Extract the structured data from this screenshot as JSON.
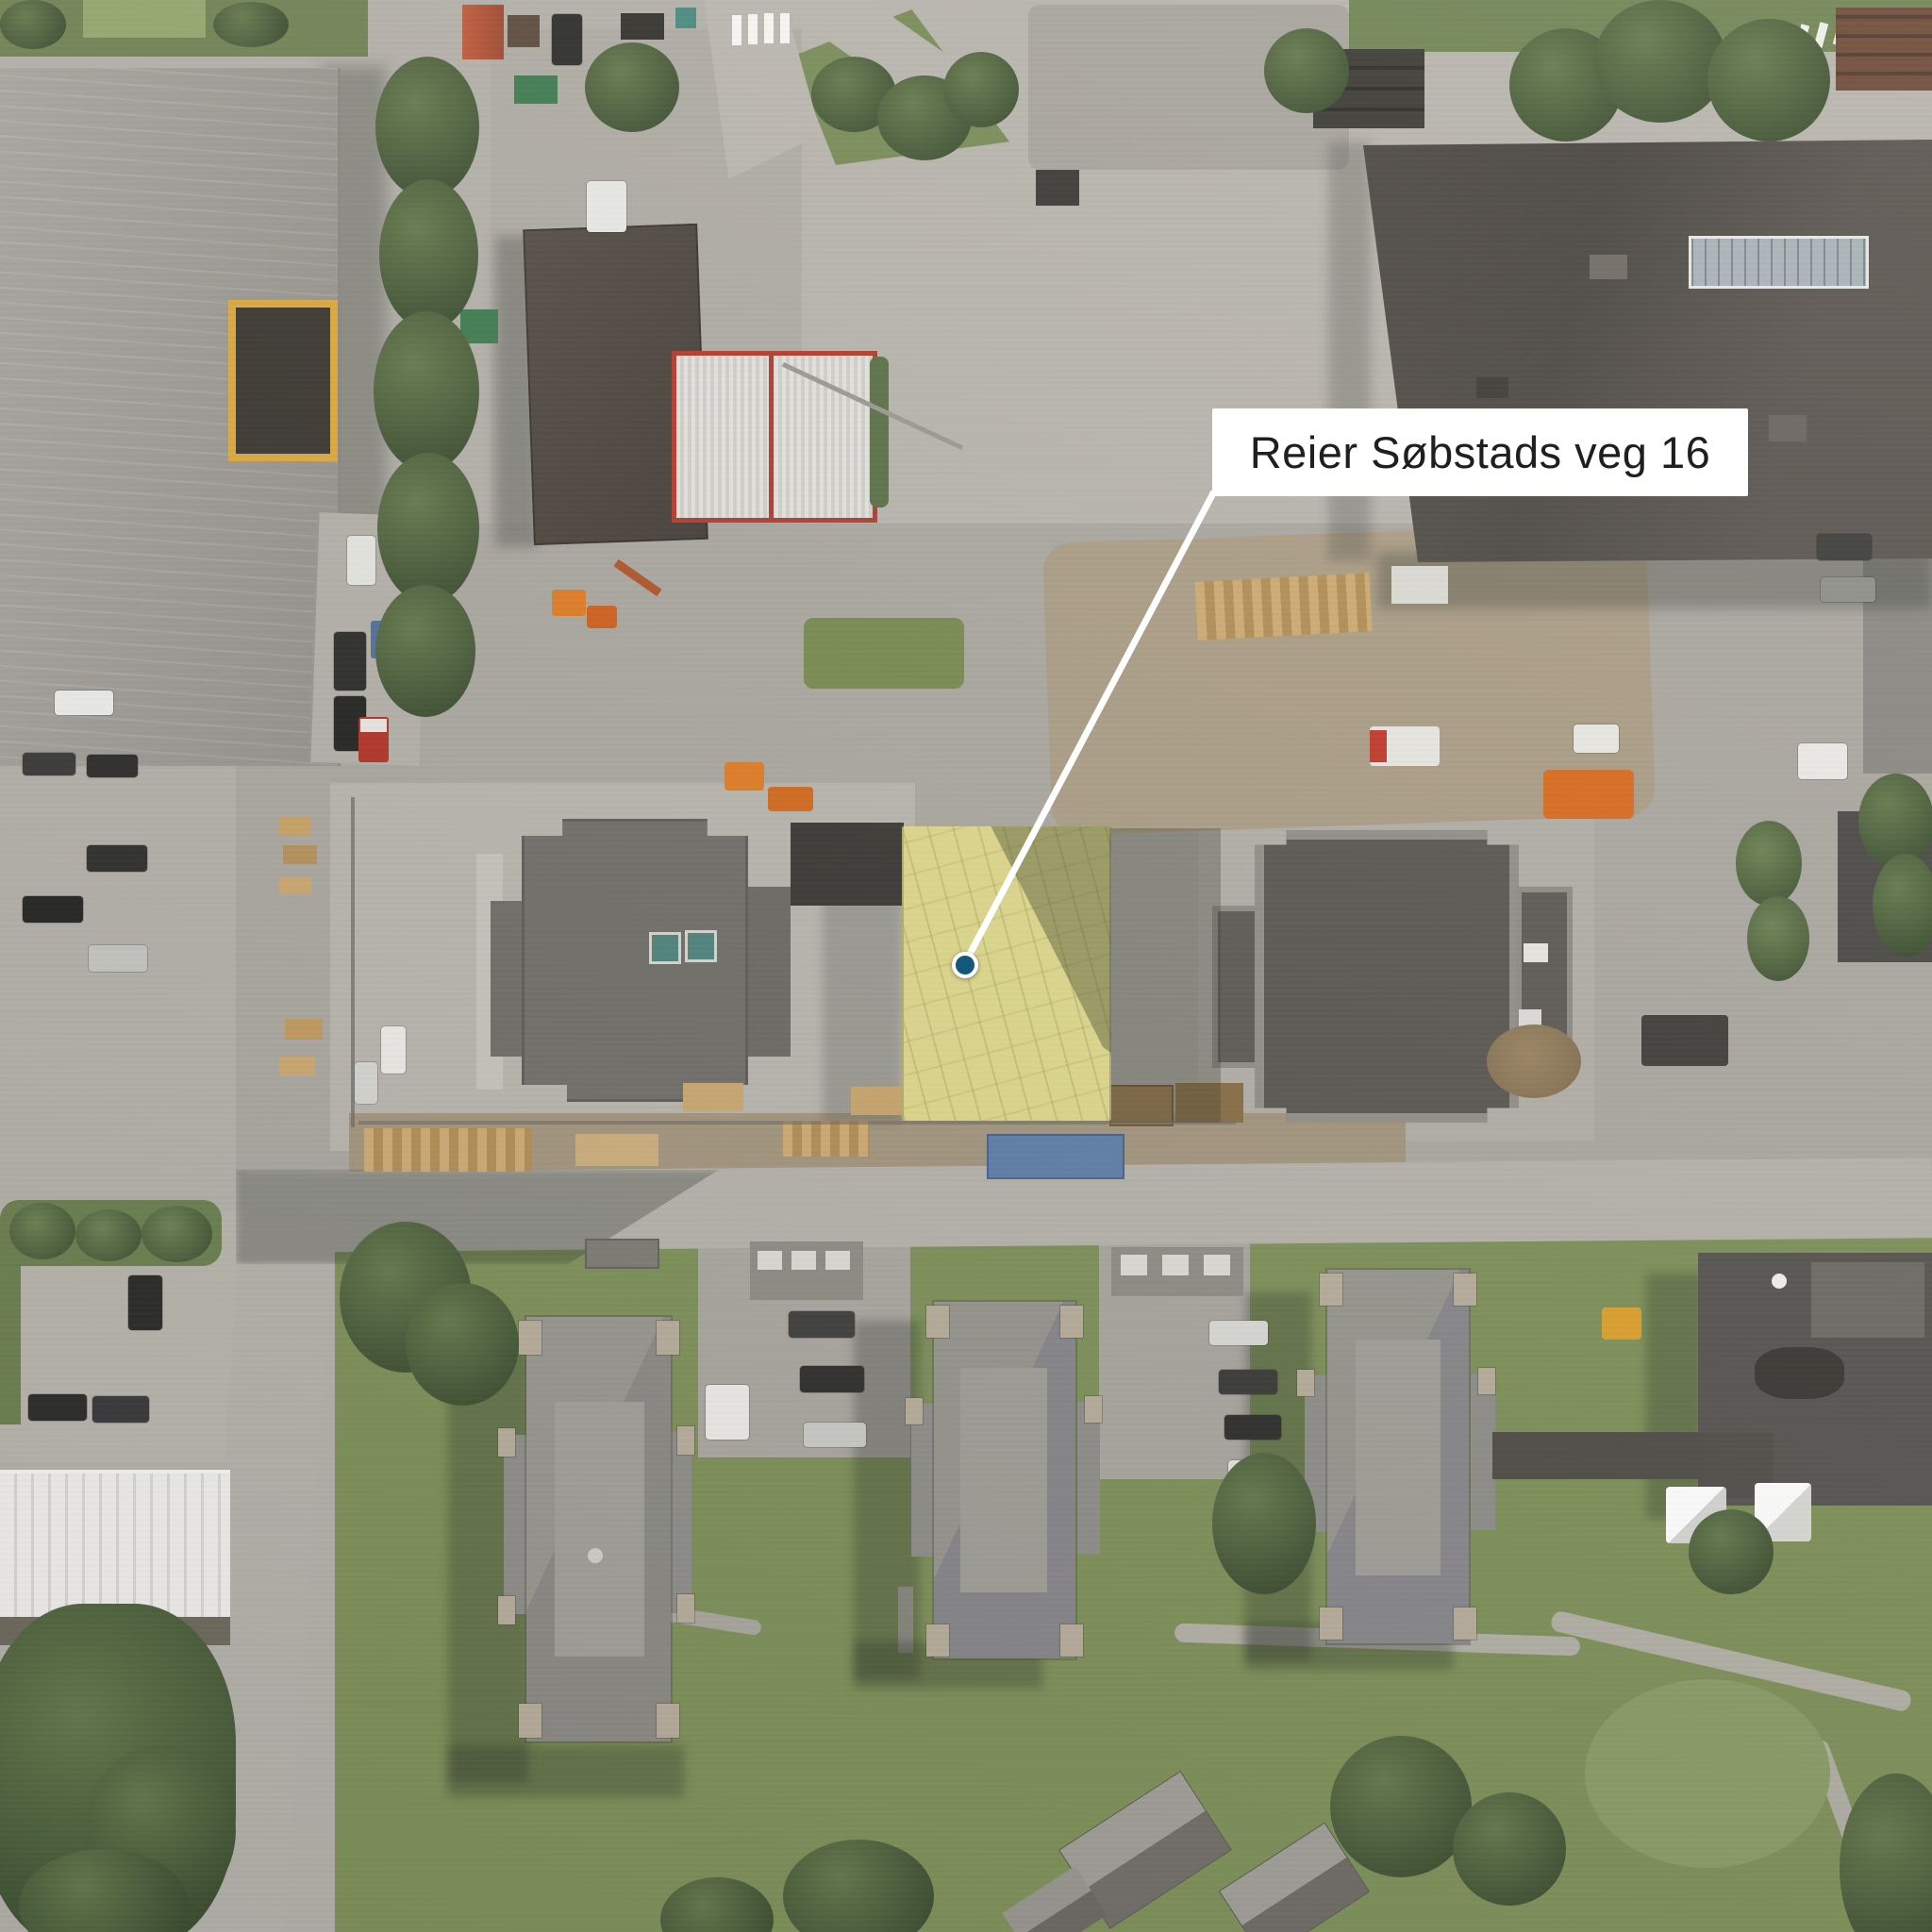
{
  "annotation": {
    "label": "Reier Søbstads veg 16"
  },
  "marker": {
    "shape": "circle-with-ring"
  },
  "colors": {
    "label_bg": "#ffffff",
    "label_text": "#1e1f21",
    "callout_line": "#ffffff",
    "marker_fill": "#15567c",
    "marker_ring": "#ffffff",
    "tarp_yellow": "#ddd78c",
    "pavement": "#b3b0a9",
    "grass": "#788b55",
    "roof_dark": "#534f4a",
    "roof_light": "#a6a39d"
  }
}
